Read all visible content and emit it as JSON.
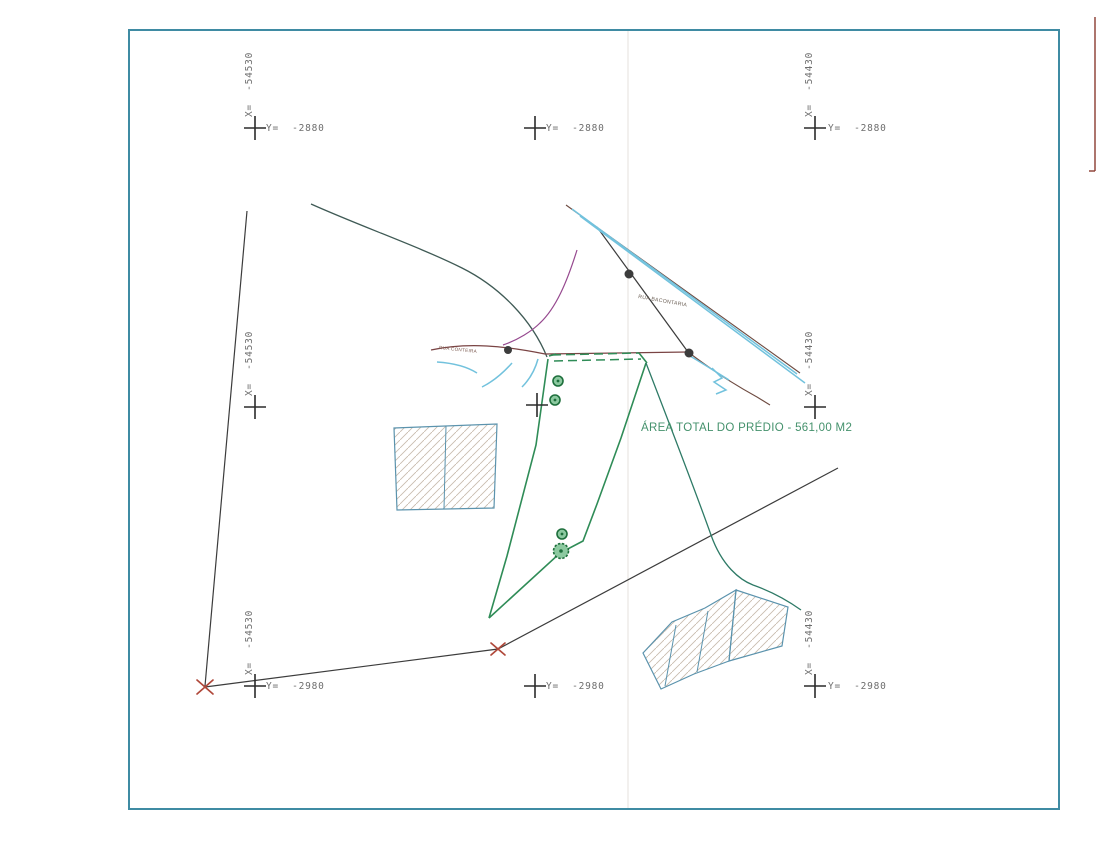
{
  "labels": {
    "area_total": "ÁREA TOTAL DO PRÉDIO - 561,00 M2",
    "street_horizontal": "RUA CONTEIRA",
    "street_diagonal": "RUA BACONTARIA"
  },
  "grid_crosses": [
    {
      "id": "top-left",
      "x_label": "X=  -54530",
      "y_label": "Y=  -2880"
    },
    {
      "id": "top-center",
      "y_label": "Y=  -2880"
    },
    {
      "id": "top-right",
      "x_label": "X=  -54430",
      "y_label": "Y=  -2880"
    },
    {
      "id": "mid-left",
      "x_label": "X=  -54530"
    },
    {
      "id": "mid-center"
    },
    {
      "id": "mid-right",
      "x_label": "X=  -54430"
    },
    {
      "id": "bottom-left",
      "x_label": "X=  -54530",
      "y_label": "Y=  -2980"
    },
    {
      "id": "bottom-center",
      "y_label": "Y=  -2980"
    },
    {
      "id": "bottom-right",
      "x_label": "X=  -54430",
      "y_label": "Y=  -2980"
    }
  ],
  "colors": {
    "frame_blue": "#3f8ba3",
    "line_dark": "#3c3c3c",
    "boundary_green": "#2f8c57",
    "road_maroon": "#7a4444",
    "road_brown": "#6e4b41",
    "water_cyan": "#72c2dd",
    "curve_magenta": "#96498f",
    "curve_teal": "#2e7a66",
    "building_blue": "#5b93ad",
    "hatch_gray": "#c9bcae",
    "tree_green": "#1e6f3c",
    "tree_fill": "#8cc9a0",
    "mark_red": "#b0483a",
    "grid_label_gray": "#6e6e6e",
    "cross_black": "#2b2b2b",
    "area_label_green": "#44916c",
    "street_label_brown": "#7c5a50",
    "paper_edge_red": "#8a3b30",
    "fold_gray": "#e8e6e2"
  }
}
